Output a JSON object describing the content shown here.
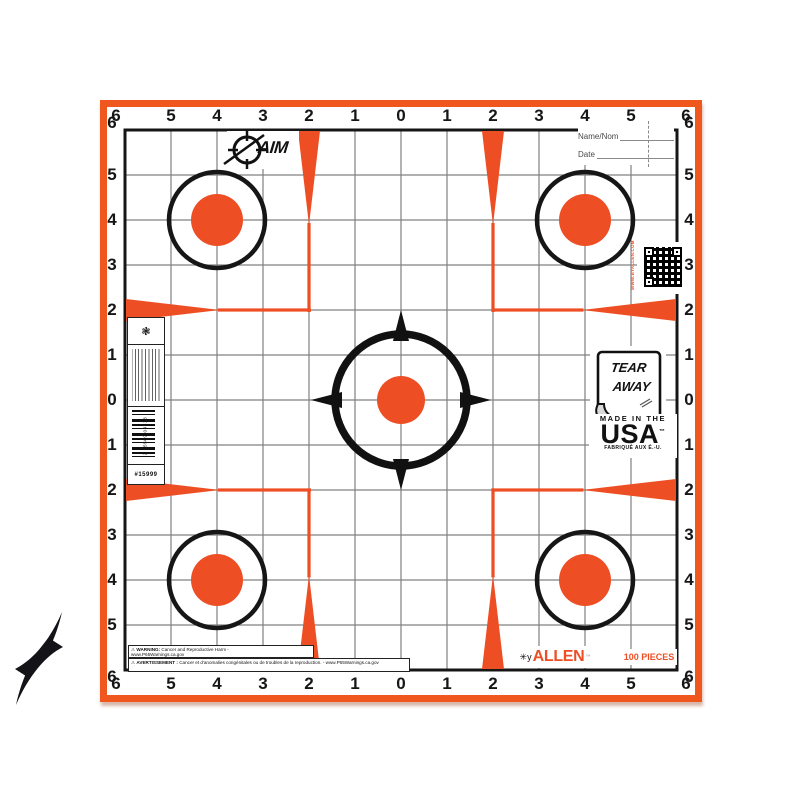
{
  "product": {
    "brand_aim": "AIM",
    "brand_allen": "ALLEN",
    "allen_tm": "™",
    "pieces": "100 PIECES"
  },
  "fields": {
    "name_label": "Name/Nom",
    "date_label": "Date"
  },
  "grid": {
    "labels": [
      "6",
      "5",
      "4",
      "3",
      "2",
      "1",
      "0",
      "1",
      "2",
      "3",
      "4",
      "5",
      "6"
    ]
  },
  "badges": {
    "tear_line1": "TEAR",
    "tear_line2": "AWAY",
    "made_in_the": "MADE IN THE",
    "usa": "USA",
    "usa_tm": "™",
    "fabrique": "FABRIQUÉ AUX É.-U."
  },
  "side_label": {
    "barcode_digits": "2 65509 04813",
    "sku": "#15999"
  },
  "qr": {
    "caption": "WWW.BYALLEN.COM"
  },
  "warnings": {
    "warn_symbol": "⚠",
    "en_label": "WARNING:",
    "en_text": " Cancer and Reproductive Harm -",
    "en_url": " www.P65Warnings.ca.gov",
    "fr_label": "AVERTISSEMENT :",
    "fr_text": " Cancer et d'anomalies congénitales ou de troubles de la reproduction. - www.P65Warnings.ca.gov"
  },
  "colors": {
    "orange": "#EE4E23",
    "frame": "#F0571F",
    "grid_line": "#808080"
  }
}
